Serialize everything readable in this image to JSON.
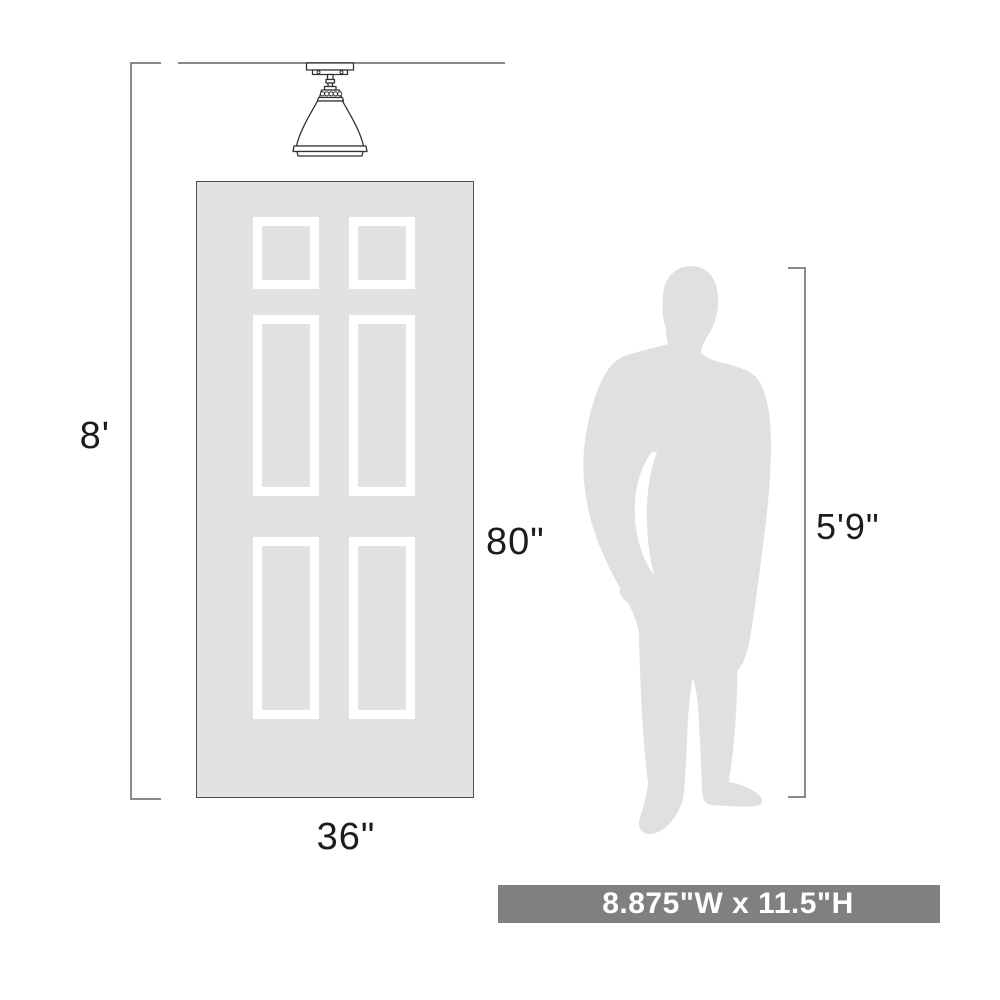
{
  "diagram": {
    "description": "Product scale diagram: semi-flush ceiling light mounted above a six-panel door next to a human silhouette",
    "labels": {
      "ceiling_height": "8'",
      "door_height": "80\"",
      "door_width": "36\"",
      "person_height": "5'9\"",
      "product_size": "8.875\"W x 11.5\"H"
    },
    "icons": {
      "fixture": "ceiling-light-fixture-icon",
      "person": "male-silhouette-icon"
    },
    "colors": {
      "background": "#ffffff",
      "door_fill": "#e2e2e2",
      "door_border": "#4d4d4d",
      "panel_frame": "#ffffff",
      "silhouette_fill": "#e0e0e0",
      "dimension_line": "#8a8a8a",
      "fixture_stroke": "#333333",
      "label_text": "#1c1c1c",
      "banner_bg": "#808080",
      "banner_text": "#ffffff"
    },
    "door_panels_count": 6
  }
}
